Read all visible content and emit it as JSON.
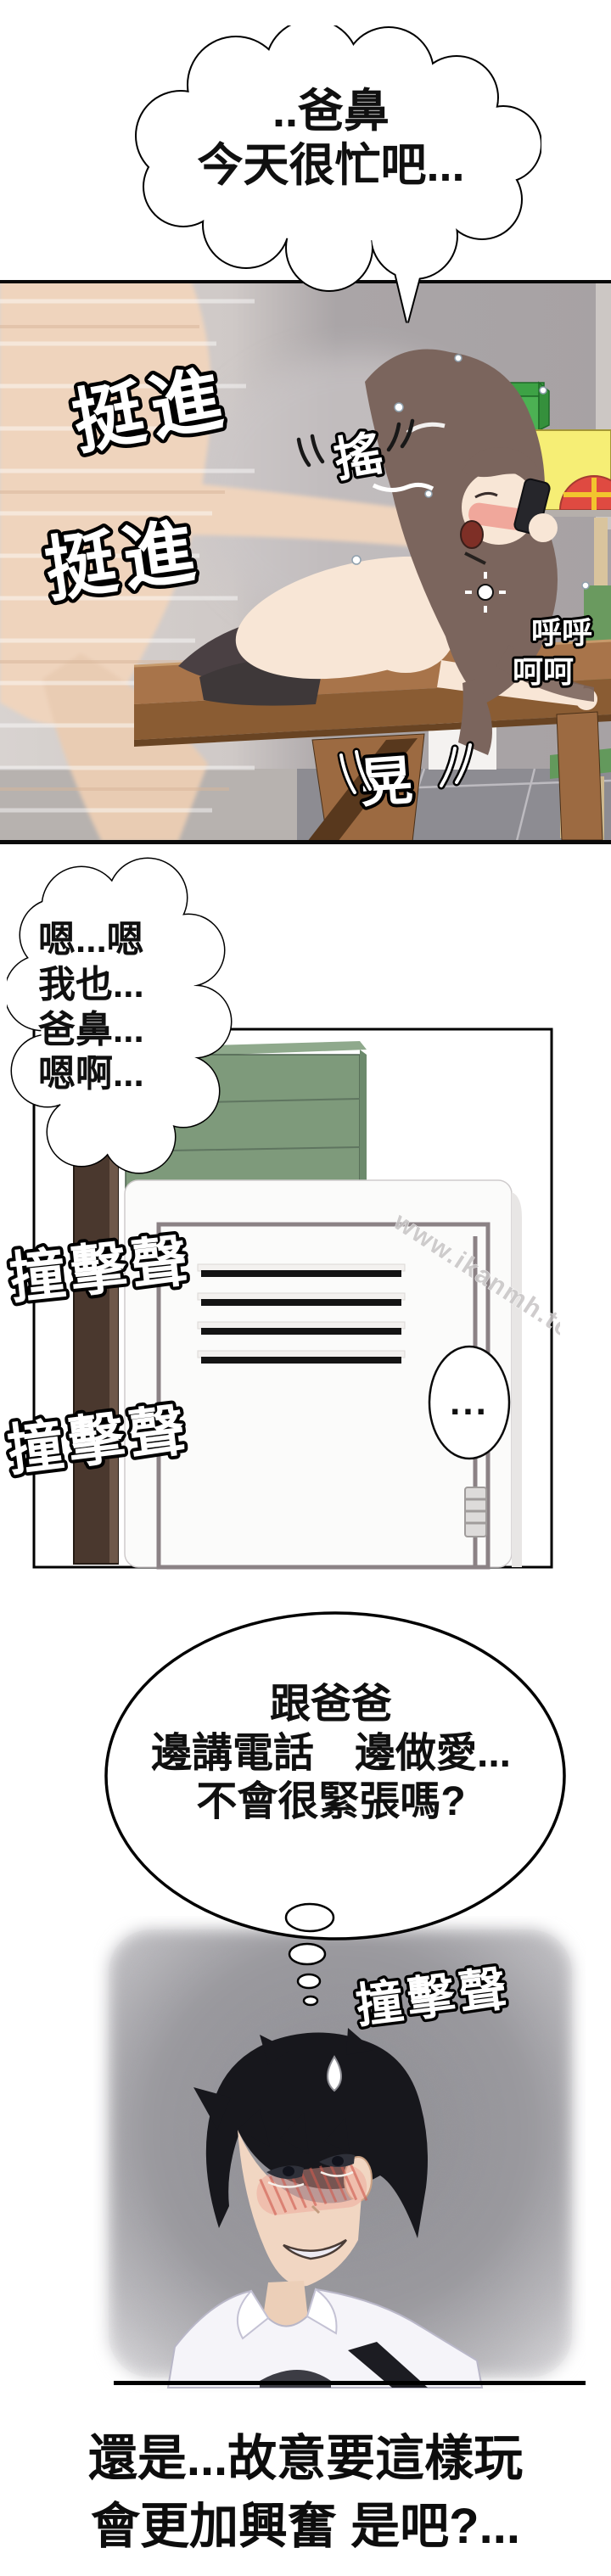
{
  "comic": {
    "speech_top": "..爸鼻\n今天很忙吧...",
    "speech_moan": "嗯...嗯\n我也...\n爸鼻...\n嗯啊...",
    "thought": "跟爸爸\n邊講電話　邊做愛...\n不會很緊張嗎?",
    "silence": "...",
    "caption": "還是...故意要這樣玩\n會更加興奮 是吧?...",
    "watermark": "www.ikanmh.top",
    "sfx": {
      "thrust_1": "挺進",
      "thrust_2": "挺進",
      "shake": "搖",
      "sway": "晃",
      "breath_1": "呼呼",
      "breath_2": "呵呵",
      "bang_1": "撞擊聲",
      "bang_2": "撞擊聲",
      "bang_3": "撞擊聲"
    },
    "colors": {
      "outline": "#000000",
      "skin": "#f2d8c3",
      "skin_light": "#f8e6d6",
      "woman_hair": "#7b655d",
      "tights": "#4a4043",
      "wall_light": "#d6d1ce",
      "wall_dark": "#a9a4a6",
      "floor_gray": "#8d8c92",
      "table_top": "#a8744a",
      "table_front": "#8a5c33",
      "chair_green": "#63995c",
      "box_green": "#4cb153",
      "house_yellow": "#f6ee75",
      "window_red": "#df4a41",
      "cabinet_green": "#7e9a7b",
      "post_brown": "#4a382e",
      "locker_white": "#fbfbfa",
      "locker_frame": "#8b8285",
      "noise_gray": "#97969b",
      "man_hair": "#17171c",
      "blush_red": "#d05848",
      "shirt_white": "#f5f4f9",
      "sfx_fill": "#ffffff"
    }
  }
}
